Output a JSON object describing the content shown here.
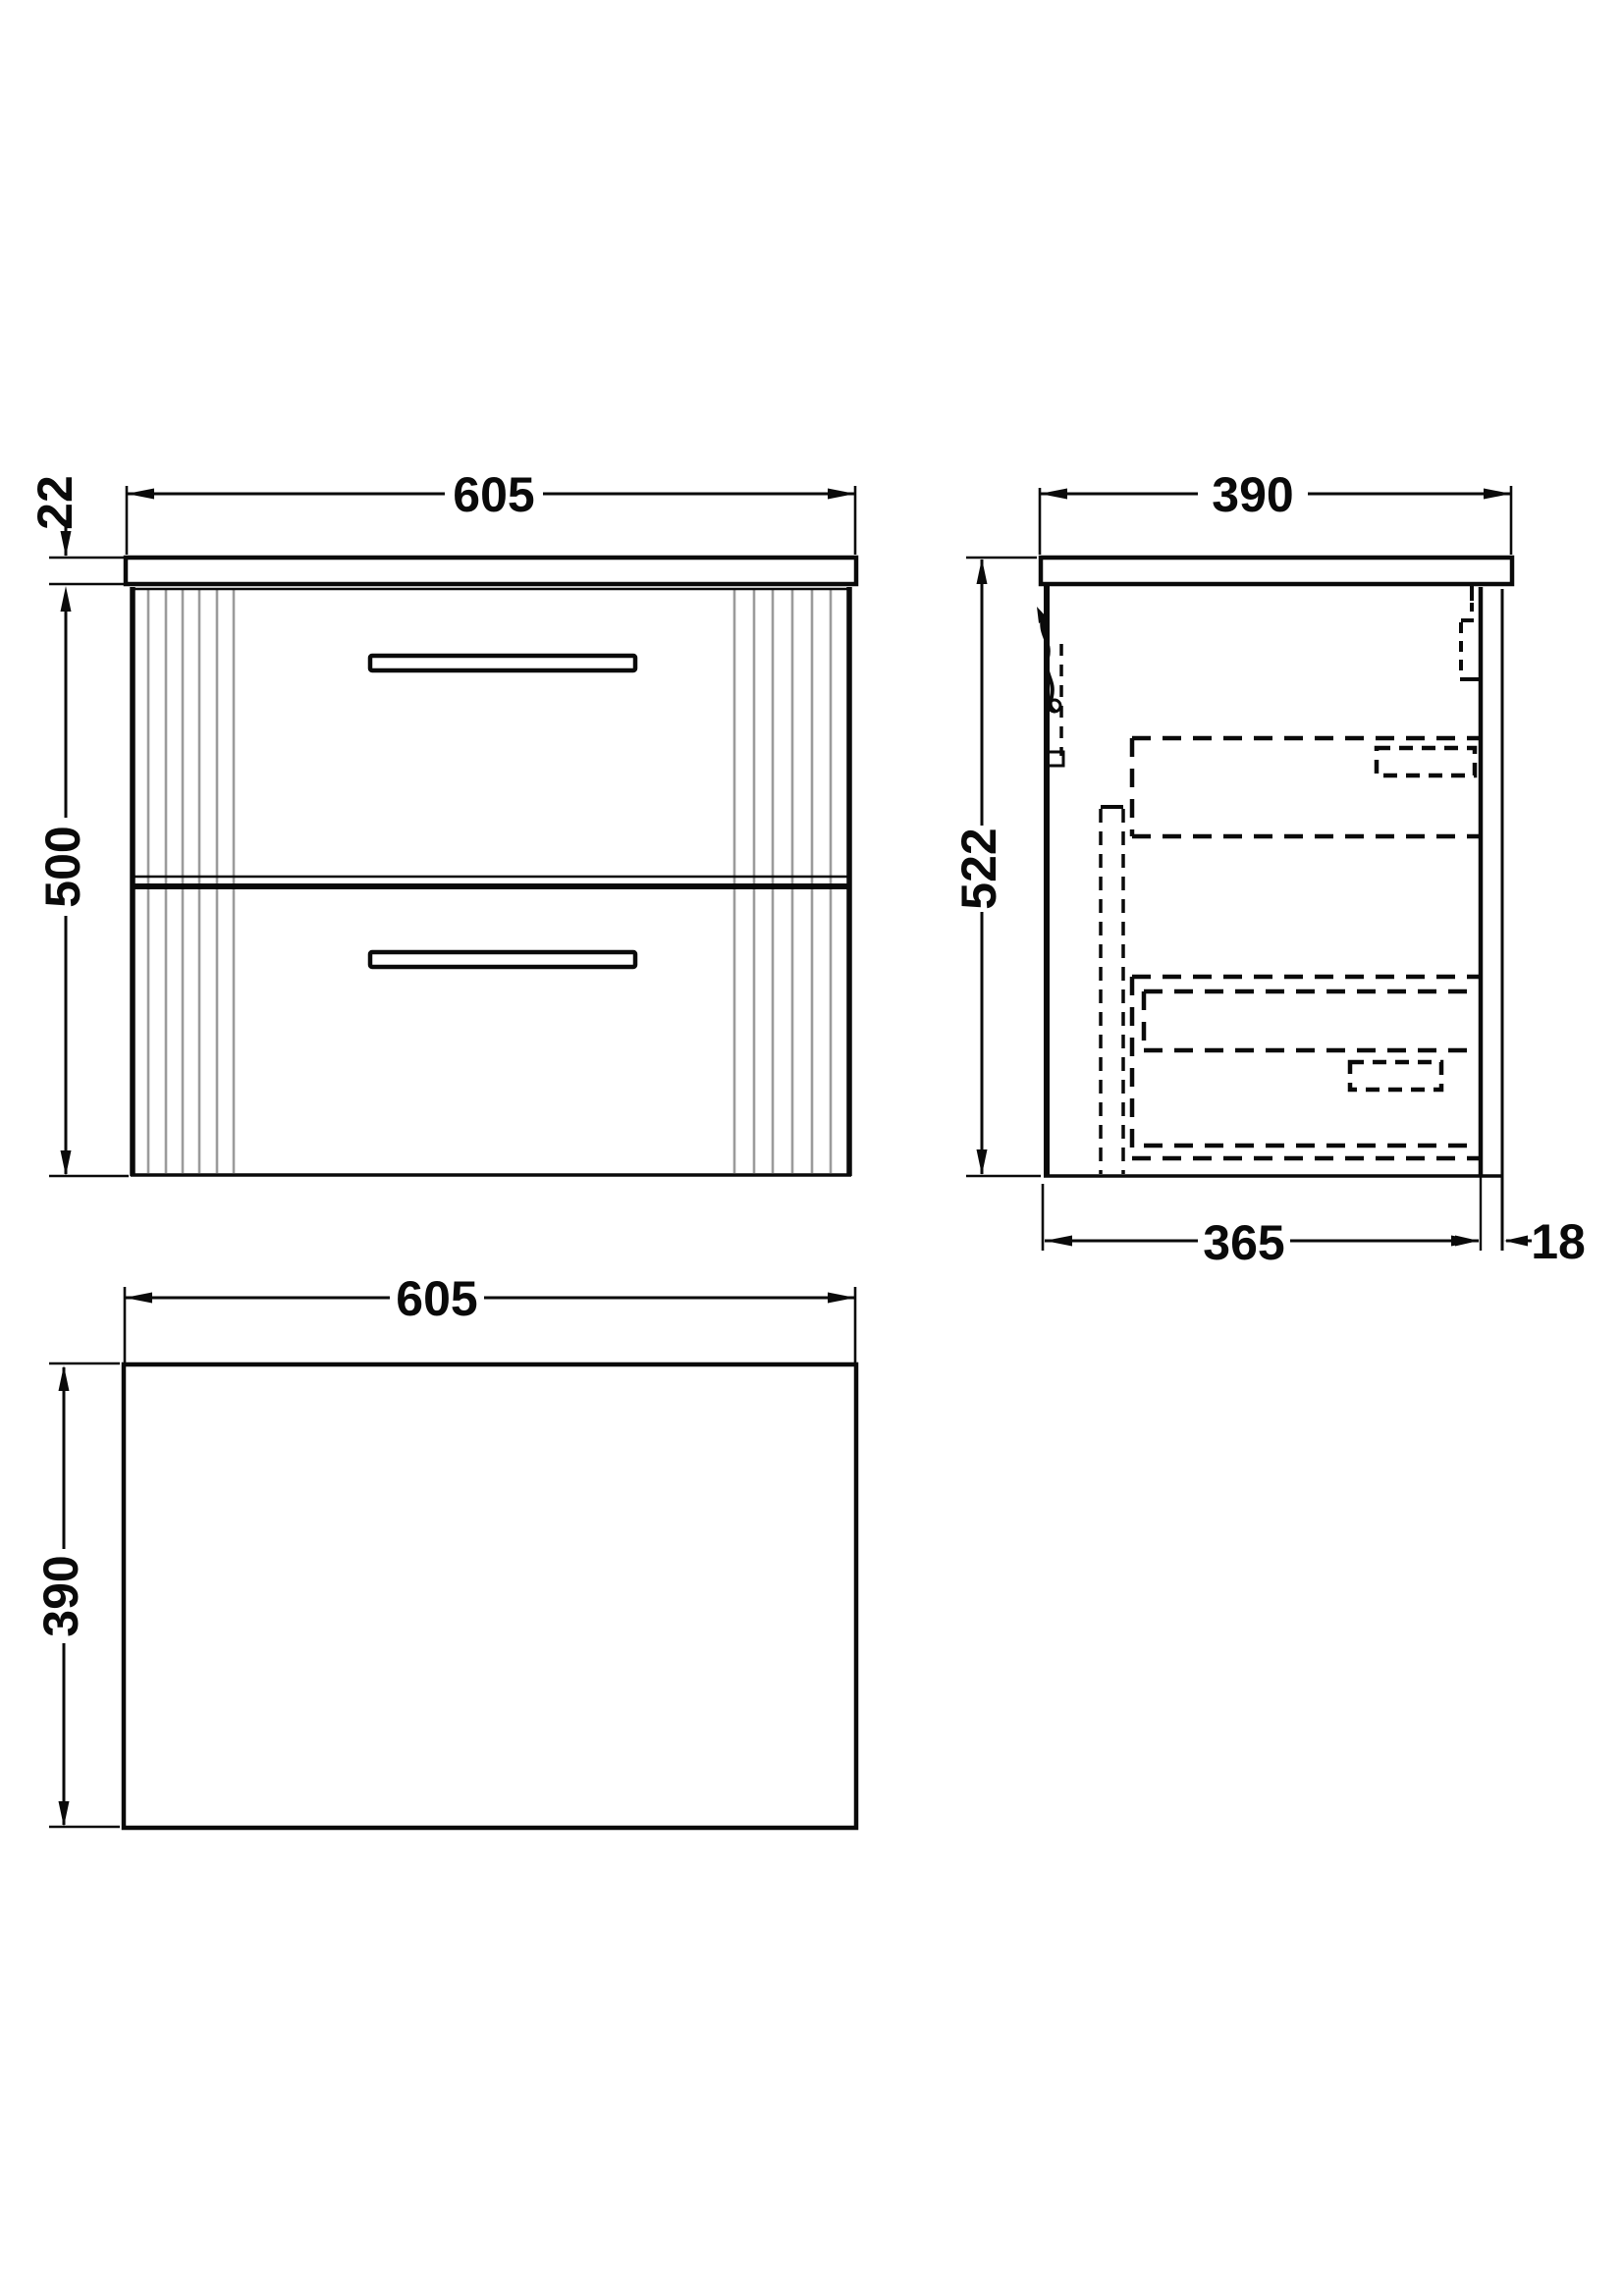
{
  "meta": {
    "kind": "technical-drawing",
    "subject": "wall-hung two-drawer vanity unit with worktop, three orthographic views"
  },
  "colors": {
    "line": "#0a0a0a",
    "flute": "#9b9b9b",
    "background": "#ffffff"
  },
  "views": {
    "front": {
      "name": "front-elevation",
      "dim_width": "605",
      "dim_worktop_thickness": "22",
      "dim_height": "500"
    },
    "side": {
      "name": "side-elevation",
      "dim_depth": "390",
      "dim_height": "522",
      "dim_carcase_depth": "365",
      "dim_back_gap": "18"
    },
    "plan": {
      "name": "plan-view",
      "dim_width": "605",
      "dim_depth": "390"
    }
  }
}
